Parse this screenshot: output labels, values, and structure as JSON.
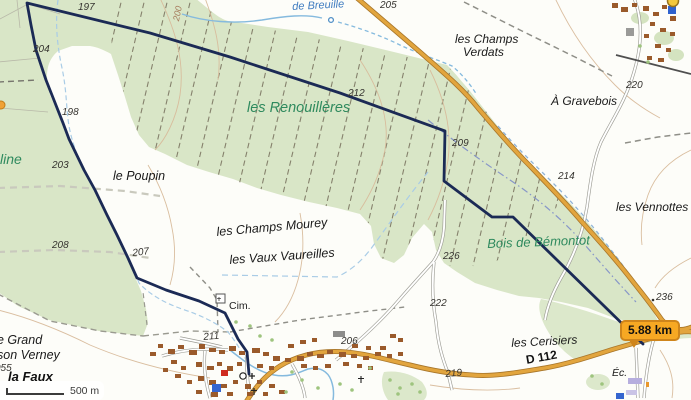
{
  "map": {
    "distance_badge": {
      "text": "5.88 km"
    },
    "scale_bar": {
      "label": "500 m"
    },
    "colors": {
      "route": "#1b2a55",
      "road_primary": "#e2a53e",
      "forest": "#d9e6c7",
      "badge_bg": "#f7a823",
      "water": "#85bade",
      "place_name_green": "#2f8a5e",
      "place_name_blue": "#3f7cc0"
    },
    "labels": [
      {
        "text": "les Renouillères",
        "x": 247,
        "y": 101,
        "cls": "g",
        "fs": 14.5,
        "rot": 0
      },
      {
        "text": "Bois de Bémontot",
        "x": 487,
        "y": 237,
        "cls": "g",
        "fs": 13,
        "rot": -2
      },
      {
        "text": "line",
        "x": 0,
        "y": 152,
        "cls": "g",
        "fs": 14,
        "rot": 0
      },
      {
        "text": "de Breuille",
        "x": 292,
        "y": 2,
        "cls": "b",
        "fs": 11,
        "rot": -3
      },
      {
        "text": "les Champs",
        "x": 455,
        "y": 33,
        "cls": "p",
        "fs": 12,
        "rot": 0
      },
      {
        "text": "Verdats",
        "x": 463,
        "y": 46,
        "cls": "p",
        "fs": 12,
        "rot": 0
      },
      {
        "text": "À Gravebois",
        "x": 551,
        "y": 95,
        "cls": "p",
        "fs": 12,
        "rot": 0
      },
      {
        "text": "les Vennottes",
        "x": 616,
        "y": 201,
        "cls": "p",
        "fs": 12,
        "rot": 0
      },
      {
        "text": "le Poupin",
        "x": 113,
        "y": 170,
        "cls": "p",
        "fs": 12.5,
        "rot": 0
      },
      {
        "text": "les Champs Mourey",
        "x": 216,
        "y": 226,
        "cls": "p",
        "fs": 12.5,
        "rot": -5
      },
      {
        "text": "les Vaux Vaureilles",
        "x": 229,
        "y": 254,
        "cls": "p",
        "fs": 12.5,
        "rot": -4
      },
      {
        "text": "les Cerisiers",
        "x": 511,
        "y": 337,
        "cls": "p",
        "fs": 12,
        "rot": -3
      },
      {
        "text": "e Grand",
        "x": -3,
        "y": 334,
        "cls": "p",
        "fs": 12.5,
        "rot": 0
      },
      {
        "text": "son Verney",
        "x": -3,
        "y": 349,
        "cls": "p",
        "fs": 12.5,
        "rot": 0
      },
      {
        "text": "la Faux",
        "x": 8,
        "y": 370,
        "cls": "pb",
        "fs": 13,
        "rot": 0
      },
      {
        "text": "Éc.",
        "x": 612,
        "y": 368,
        "cls": "p",
        "fs": 10.5,
        "rot": 0
      },
      {
        "text": "Cim.",
        "x": 229,
        "y": 301,
        "cls": "m",
        "fs": 10.5,
        "rot": 0
      },
      {
        "text": "D 112",
        "x": 525,
        "y": 354,
        "cls": "r",
        "fs": 12,
        "rot": -10
      },
      {
        "text": "197",
        "x": 78,
        "y": 3,
        "cls": "e",
        "rot": 0
      },
      {
        "text": "204",
        "x": 33,
        "y": 45,
        "cls": "e",
        "rot": 0
      },
      {
        "text": "198",
        "x": 62,
        "y": 108,
        "cls": "e",
        "rot": 0
      },
      {
        "text": "205",
        "x": 380,
        "y": 1,
        "cls": "e",
        "rot": 0
      },
      {
        "text": "212",
        "x": 348,
        "y": 89,
        "cls": "e",
        "rot": 0
      },
      {
        "text": "209",
        "x": 452,
        "y": 139,
        "cls": "e",
        "rot": 0
      },
      {
        "text": "220",
        "x": 626,
        "y": 81,
        "cls": "e",
        "rot": 0
      },
      {
        "text": "214",
        "x": 558,
        "y": 172,
        "cls": "e",
        "rot": 0
      },
      {
        "text": "203",
        "x": 52,
        "y": 161,
        "cls": "e",
        "rot": 0
      },
      {
        "text": "208",
        "x": 52,
        "y": 241,
        "cls": "e",
        "rot": 0
      },
      {
        "text": "207",
        "x": 132,
        "y": 249,
        "cls": "e",
        "rot": -6
      },
      {
        "text": "226",
        "x": 443,
        "y": 252,
        "cls": "e",
        "rot": 0
      },
      {
        "text": "222",
        "x": 430,
        "y": 299,
        "cls": "e",
        "rot": 0
      },
      {
        "text": "211",
        "x": 203,
        "y": 333,
        "cls": "e",
        "rot": -5
      },
      {
        "text": "206",
        "x": 341,
        "y": 337,
        "cls": "e",
        "rot": 0
      },
      {
        "text": "219",
        "x": 445,
        "y": 370,
        "cls": "e",
        "rot": -5
      },
      {
        "text": "236",
        "x": 656,
        "y": 293,
        "cls": "e",
        "rot": 0
      },
      {
        "text": "055",
        "x": -5,
        "y": 364,
        "cls": "e",
        "rot": 0
      },
      {
        "text": "200",
        "x": 172,
        "y": 20,
        "cls": "c",
        "rot": -78
      }
    ]
  }
}
